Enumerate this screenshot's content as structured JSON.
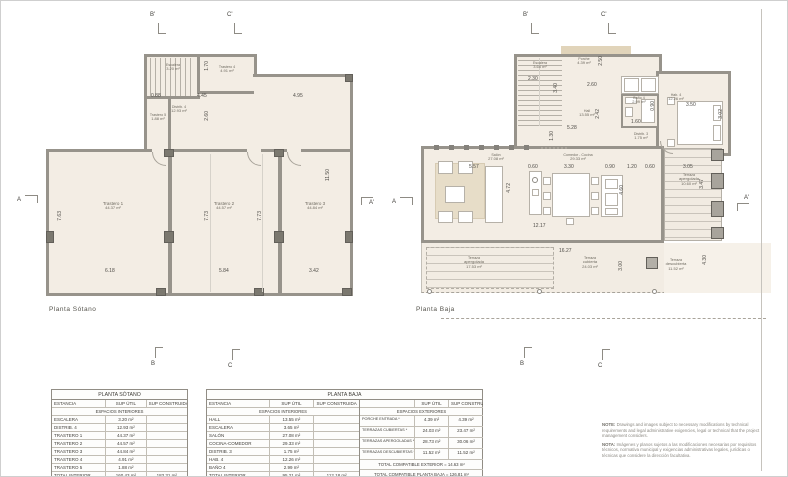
{
  "plans": {
    "sotano": {
      "caption": "Planta Sótano",
      "rooms": {
        "escalera": {
          "name": "Escalera",
          "area": "3.20 m²"
        },
        "trastero5": {
          "name": "Trastero 5",
          "area": "1.88 m²"
        },
        "trastero4": {
          "name": "Trastero 4",
          "area": "4.91 m²"
        },
        "distrib4": {
          "name": "Distrib. 4",
          "area": "12.93 m²"
        },
        "trastero1": {
          "name": "Trastero 1",
          "area": "44.37 m²"
        },
        "trastero2": {
          "name": "Trastero 2",
          "area": "44.57 m²"
        },
        "trastero3": {
          "name": "Trastero 3",
          "area": "44.84 m²"
        }
      },
      "dims": {
        "top_a": "0.88",
        "top_b": "4.45",
        "top_c": "4.95",
        "v_a": "1.70",
        "v_b": "2.60",
        "left_h": "7.63",
        "right_h": "11.50",
        "mid1_h": "7.73",
        "mid2_h": "7.73",
        "bot_a": "6.18",
        "bot_b": "5.84",
        "bot_c": "3.42"
      },
      "markers": {
        "top1": "B'",
        "top2": "C'",
        "bottom1": "B",
        "bottom2": "C",
        "left": "A",
        "right": "A'"
      }
    },
    "baja": {
      "caption": "Planta Baja",
      "rooms": {
        "escalera": {
          "name": "Escalera",
          "area": "3.65 m²"
        },
        "porche": {
          "name": "Porche",
          "area": "4.39 m²"
        },
        "hall": {
          "name": "Hall",
          "area": "13.55 m²"
        },
        "bano4": {
          "name": "Baño 4",
          "area": "2.99 m²"
        },
        "hab4": {
          "name": "Hab. 4",
          "area": "12.26 m²"
        },
        "distrib3": {
          "name": "Distrib. 3",
          "area": "1.75 m²"
        },
        "salon": {
          "name": "Salón",
          "area": "27.08 m²"
        },
        "cocina": {
          "name": "Comedor - Cocina",
          "area": "29.33 m²"
        },
        "terraza_lateral": {
          "name": "Terraza",
          "name2": "apergolada",
          "area": "10.60 m²"
        },
        "terraza_apergolada": {
          "name": "Terraza",
          "name2": "apergolada",
          "area": "17.53 m²"
        },
        "terraza_cubierta": {
          "name": "Terraza",
          "name2": "cubierta",
          "area": "24.03 m²"
        },
        "terraza_descubierta": {
          "name": "Terraza",
          "name2": "descubierta",
          "area": "11.52 m²"
        }
      },
      "dims": {
        "esc_w": "2.30",
        "esc_h": "3.40",
        "porche_w": "2.60",
        "porche_h": "2.50",
        "hall_w": "5.28",
        "hall_h": "2.42",
        "hall_s": "1.30",
        "bano_w": "1.60",
        "bano_h": "0.90",
        "hab_w": "3.50",
        "hab_h": "3.02",
        "salon_w": "5.57",
        "salon_h": "4.72",
        "isl_w": "0.60",
        "table_w": "3.30",
        "counter_w": "0.90",
        "gap_a": "1.20",
        "gap_b": "0.60",
        "strip_w": "3.05",
        "cocina_h": "4.60",
        "main_w": "12.17",
        "terr_w": "16.27",
        "terr_h": "3.00",
        "strip_h": "3.47",
        "desc_h": "4.30"
      },
      "markers": {
        "top1": "B'",
        "top2": "C'",
        "bottom1": "B",
        "bottom2": "C",
        "left": "A",
        "right": "A'"
      }
    }
  },
  "tables": {
    "sotano": {
      "title": "PLANTA SÓTANO",
      "headers": [
        "ESTANCIA",
        "SUP ÚTIL",
        "SUP CONSTRUIDA"
      ],
      "section": "ESPACIOS INTERIORES",
      "rows": [
        [
          "ESCALERA",
          "3.20 m²",
          ""
        ],
        [
          "DISTRIB. 4",
          "12.93 m²",
          ""
        ],
        [
          "TRASTERO 1",
          "44.37 m²",
          ""
        ],
        [
          "TRASTERO 2",
          "44.57 m²",
          ""
        ],
        [
          "TRASTERO 3",
          "44.84 m²",
          ""
        ],
        [
          "TRASTERO 4",
          "4.91 m²",
          ""
        ],
        [
          "TRASTERO 5",
          "1.88 m²",
          ""
        ]
      ],
      "total": [
        "TOTAL INTERIOR",
        "160.43 m²",
        "183.31 m²"
      ],
      "footer": "TOTAL COMPATIBLE SÓTANO = 0.00 m²"
    },
    "baja": {
      "title": "PLANTA BAJA",
      "interior": {
        "headers": [
          "ESTANCIA",
          "SUP ÚTIL",
          "SUP CONSTRUIDA"
        ],
        "section": "ESPACIOS INTERIORES",
        "rows": [
          [
            "HALL",
            "13.55 m²",
            ""
          ],
          [
            "ESCALERA",
            "3.65 m²",
            ""
          ],
          [
            "SALÓN",
            "27.08 m²",
            ""
          ],
          [
            "COCINA-COMEDOR",
            "29.33 m²",
            ""
          ],
          [
            "DISTRIB. 3",
            "1.75 m²",
            ""
          ],
          [
            "HAB. 4",
            "12.26 m²",
            ""
          ],
          [
            "BAÑO 4",
            "2.99 m²",
            ""
          ]
        ],
        "total": [
          "TOTAL INTERIOR",
          "95.21 m²",
          "112.18 m²"
        ],
        "footer": "TOTAL COMPATIBLE INTERIOR = 112.18 m²"
      },
      "exterior": {
        "headers": [
          "",
          "SUP ÚTIL",
          "SUP CONSTRUIDA"
        ],
        "section": "ESPACIOS EXTERIORES",
        "rows": [
          [
            "PORCHE ENTRADA *",
            "4.39 m²",
            "4.39 m²"
          ],
          [
            "TERRAZAS CUBIERTAS *",
            "24.03 m²",
            "23.47 m²"
          ],
          [
            "TERRAZAS APERGOLADAS **",
            "28.73 m²",
            "30.06 m²"
          ],
          [
            "TERRAZAS DESCUBIERTAS **",
            "11.52 m²",
            "11.52 m²"
          ]
        ],
        "total_exterior": "TOTAL COMPATIBLE EXTERIOR = 14.63 m²",
        "total_planta": "TOTAL COMPATIBLE PLANTA BAJA = 126.81 m²",
        "footnotes": [
          "* = Computa al 50 %",
          "** = No computa"
        ]
      }
    }
  },
  "notes": {
    "note1_label": "NOTE:",
    "note1_text": " Drawings and images subject to necessary modifications by technical requirements and legal administrative exigencies, legal or technical that the project management considers.",
    "note2_label": "NOTA:",
    "note2_text": " Imágenes y planos sujetos a las modificaciones necesarias por requisitos técnicos, normativa municipal y exigencias administrativas legales, jurídicas o técnicas que considere la dirección facultativa."
  }
}
